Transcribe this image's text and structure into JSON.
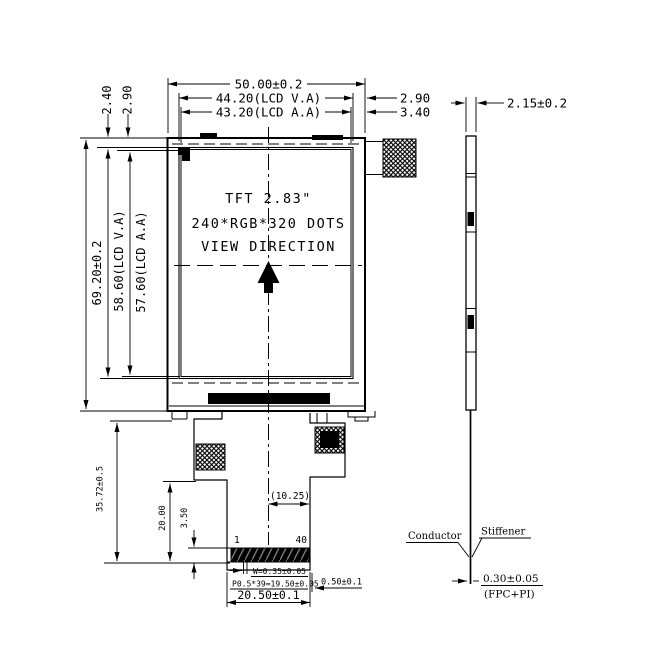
{
  "panel": {
    "line1": "TFT 2.83\"",
    "line2": "240*RGB*320 DOTS",
    "line3": "VIEW DIRECTION"
  },
  "d": {
    "w_total": "50.00±0.2",
    "w_va": "44.20(LCD V.A)",
    "w_aa": "43.20(LCD A.A)",
    "gap_right_va": "2.90",
    "gap_right_aa": "3.40",
    "gap_top_va": "2.40",
    "gap_top_aa": "2.90",
    "h_total": "69.20±0.2",
    "h_va": "58.60(LCD V.A)",
    "h_aa": "57.60(LCD A.A)",
    "fpc_length": "35.72±0.5",
    "tail_length": "20.00",
    "contact_length": "3.50",
    "center_offset": "(10.25)",
    "pin_first": "1",
    "pin_last": "40",
    "contact_width": "W=0.35±0.05",
    "pitch": "P0.5*39=19.50±0.05",
    "end_margin": "0.50±0.1",
    "connector_width": "20.50±0.1",
    "thickness": "2.15±0.2",
    "conductor": "Conductor",
    "stiffener": "Stiffener",
    "fpc_thickness": "0.30±0.05",
    "fpc_note": "(FPC+PI)"
  }
}
